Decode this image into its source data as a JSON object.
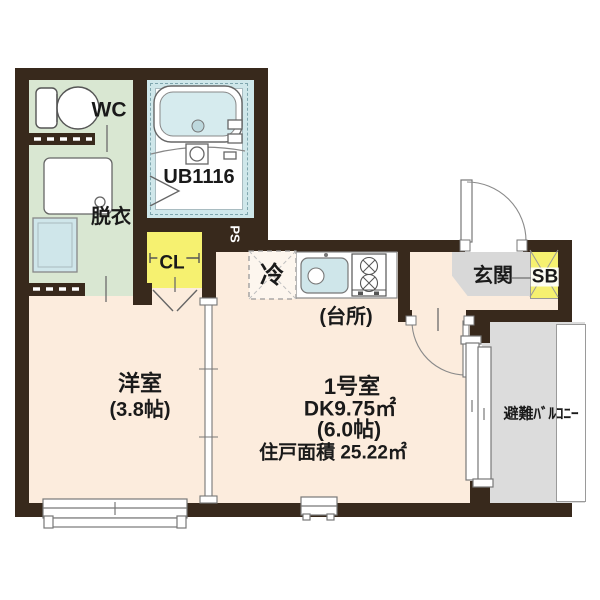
{
  "plan_title": "apartment-floor-plan",
  "rooms": {
    "wc": {
      "label": "WC"
    },
    "dressing": {
      "label": "脱衣"
    },
    "unit_bath": {
      "label": "UB1116"
    },
    "closet": {
      "label": "CL"
    },
    "pipe_space": {
      "label": "PS"
    },
    "refrigerator": {
      "label": "冷"
    },
    "kitchen": {
      "label": "(台所)"
    },
    "entrance": {
      "label": "玄関"
    },
    "shoe_box": {
      "label": "SB"
    },
    "western_room": {
      "label": "洋室",
      "size": "(3.8帖)"
    },
    "main_room": {
      "label": "1号室",
      "dk_area": "DK9.75㎡",
      "dk_size": "(6.0帖)",
      "unit_area": "住戸面積 25.22㎡"
    },
    "balcony": {
      "label": "避難ﾊﾞﾙｺﾆｰ"
    }
  },
  "colors": {
    "wall": "#38291c",
    "room_floor": "#fcecdd",
    "wet_area_floor": "#d9e7d2",
    "bath_floor": "#cfe7ea",
    "closet_fill": "#f6f170",
    "entrance_floor": "#d8d8d8",
    "balcony_floor": "#dcdcdc",
    "line": "#6b6b6b"
  }
}
